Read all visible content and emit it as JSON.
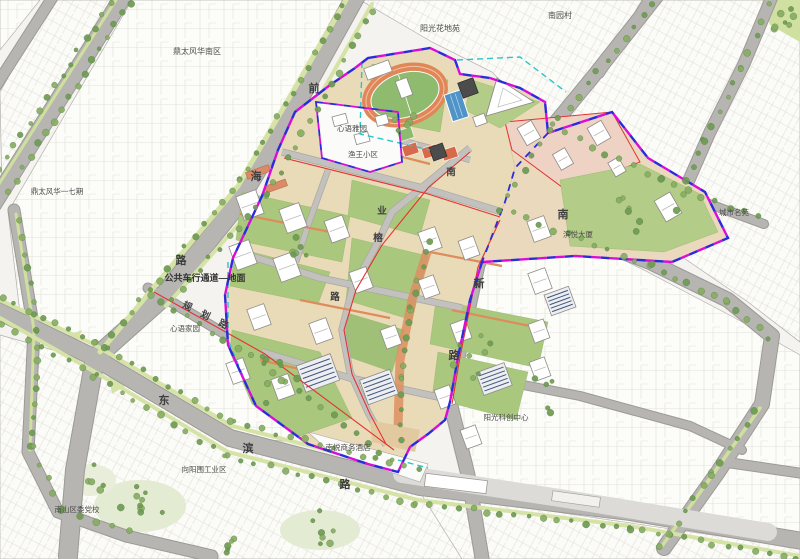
{
  "roads": [
    {
      "name": "前海路",
      "chars": [
        {
          "c": "前"
        },
        {
          "c": "海"
        },
        {
          "c": "路"
        }
      ]
    },
    {
      "name": "规划路",
      "chars": [
        {
          "c": "规"
        },
        {
          "c": "划"
        },
        {
          "c": "路"
        }
      ]
    },
    {
      "name": "东滨路",
      "chars": [
        {
          "c": "东"
        },
        {
          "c": "滨"
        },
        {
          "c": "路"
        }
      ]
    },
    {
      "name": "南新路",
      "chars": [
        {
          "c": "南"
        },
        {
          "c": "新"
        },
        {
          "c": "路"
        }
      ]
    },
    {
      "name": "南业榕路",
      "chars": [
        {
          "c": "南"
        },
        {
          "c": "业"
        },
        {
          "c": "榕"
        },
        {
          "c": "路"
        }
      ]
    }
  ],
  "places": [
    {
      "name": "鼎太风华南区"
    },
    {
      "name": "鼎太风华一七期"
    },
    {
      "name": "阳光花地苑"
    },
    {
      "name": "南园村"
    },
    {
      "name": "心语雅园"
    },
    {
      "name": "渔王小区"
    },
    {
      "name": "城市名苑"
    },
    {
      "name": "滨悦大厦"
    },
    {
      "name": "心语家园"
    },
    {
      "name": "公共车行通道—地面"
    },
    {
      "name": "南悦商务酒店"
    },
    {
      "name": "向阳围工业区"
    },
    {
      "name": "南山区委党校"
    },
    {
      "name": "阳光科创中心"
    }
  ],
  "colors": {
    "boundary_blue": "#2b2bdc",
    "boundary_magenta": "#d80ed8",
    "parcel_red": "#e23333",
    "guide_cyan": "#29c5c9",
    "site_ground": "#e9dab8",
    "lawn_green": "#a9c77d",
    "road_gray": "#b7b5b2",
    "track_orange": "#e0875a",
    "pool_blue": "#4f93c8"
  }
}
